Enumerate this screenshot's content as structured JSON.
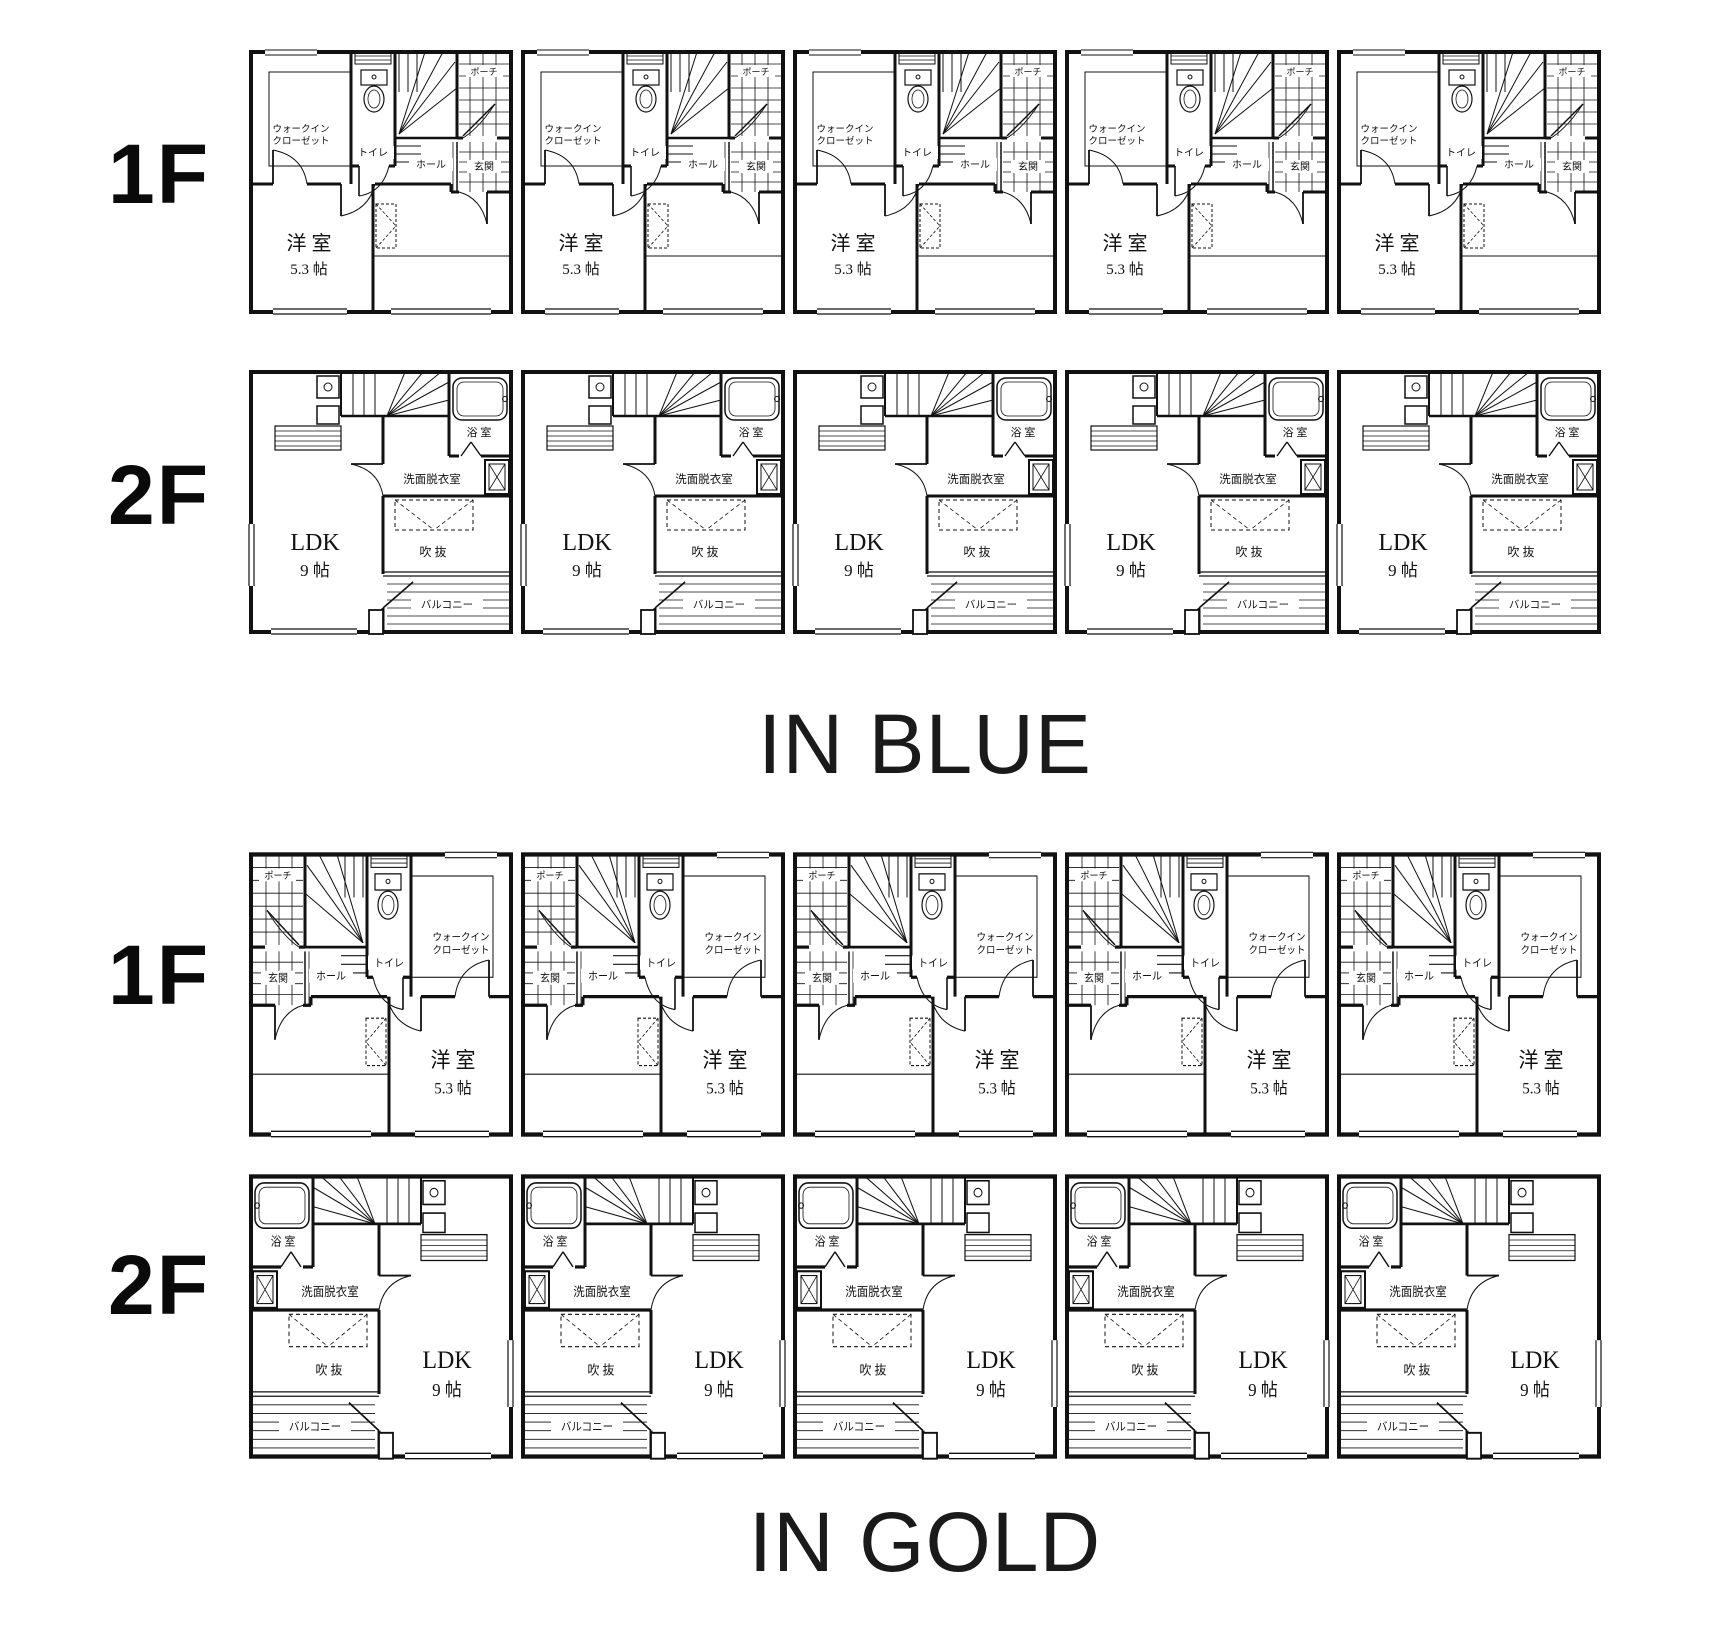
{
  "sheet": {
    "background": "#ffffff",
    "line_color": "#111111"
  },
  "buildings": [
    {
      "name": "IN BLUE",
      "floors": [
        {
          "label": "1F",
          "plan": "f1",
          "unit_count": 5,
          "mirrored": false
        },
        {
          "label": "2F",
          "plan": "f2",
          "unit_count": 5,
          "mirrored": false
        }
      ]
    },
    {
      "name": "IN GOLD",
      "floors": [
        {
          "label": "1F",
          "plan": "f1",
          "unit_count": 5,
          "mirrored": true
        },
        {
          "label": "2F",
          "plan": "f2",
          "unit_count": 5,
          "mirrored": true
        }
      ]
    }
  ],
  "rooms": {
    "f1": {
      "wic_line1": "ウォークイン",
      "wic_line2": "クローゼット",
      "toilet": "トイレ",
      "hall": "ホール",
      "entrance": "玄関",
      "porch": "ポーチ",
      "western_room": "洋 室",
      "western_room_size": "5.3 帖"
    },
    "f2": {
      "ldk": "LDK",
      "ldk_size": "9 帖",
      "bath": "浴 室",
      "washroom": "洗面脱衣室",
      "void": "吹 抜",
      "balcony": "バルコニー"
    }
  }
}
